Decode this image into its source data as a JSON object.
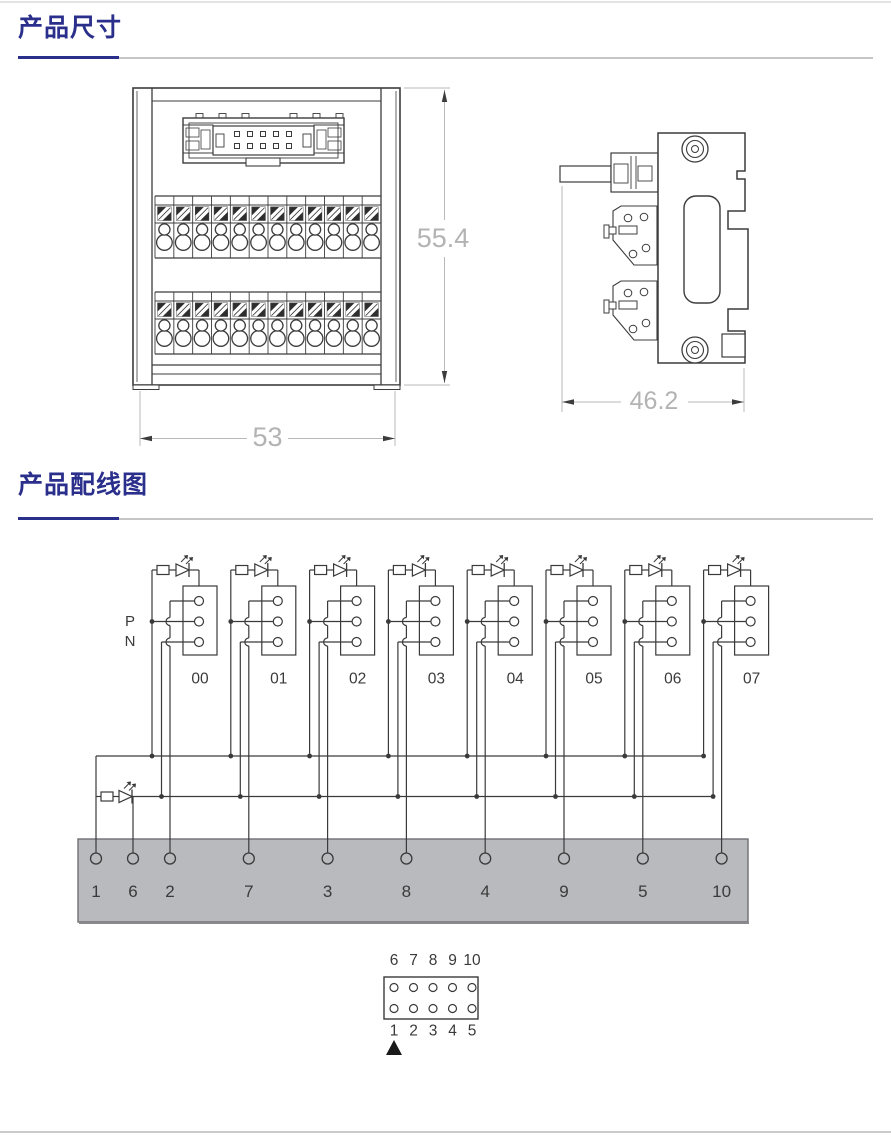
{
  "page": {
    "background": "#ffffff",
    "top_rule_color": "#e3e3e3",
    "bottom_rule_color": "#cbcbcb"
  },
  "sections": [
    {
      "title": "产品尺寸",
      "accent_color": "#2b2f8c",
      "rule_color": "#c6c6c6"
    },
    {
      "title": "产品配线图",
      "accent_color": "#2b2f8c",
      "rule_color": "#c6c6c6"
    }
  ],
  "dimension_drawing": {
    "line_color": "#3c3c3c",
    "dim_line_color": "#b8b8b8",
    "dim_text_color": "#b3b3b3",
    "front_view": {
      "width_label": "53",
      "height_label": "55.4",
      "terminal_rows": 2,
      "terminals_per_row": 12
    },
    "side_view": {
      "depth_label": "46.2"
    }
  },
  "wiring_diagram": {
    "wire_color": "#3a3a3a",
    "text_color": "#3a3a3a",
    "p_label": "P",
    "n_label": "N",
    "channels": [
      {
        "label": "00",
        "terminal": "2"
      },
      {
        "label": "01",
        "terminal": "7"
      },
      {
        "label": "02",
        "terminal": "3"
      },
      {
        "label": "03",
        "terminal": "8"
      },
      {
        "label": "04",
        "terminal": "4"
      },
      {
        "label": "05",
        "terminal": "9"
      },
      {
        "label": "06",
        "terminal": "5"
      },
      {
        "label": "07",
        "terminal": "10"
      }
    ],
    "bus_bar": {
      "fill": "#b9babe",
      "border": "#6f6f74",
      "terminals": [
        "1",
        "6",
        "2",
        "7",
        "3",
        "8",
        "4",
        "9",
        "5",
        "10"
      ]
    },
    "pinout": {
      "top_row": [
        "6",
        "7",
        "8",
        "9",
        "10"
      ],
      "bottom_row": [
        "1",
        "2",
        "3",
        "4",
        "5"
      ]
    }
  }
}
